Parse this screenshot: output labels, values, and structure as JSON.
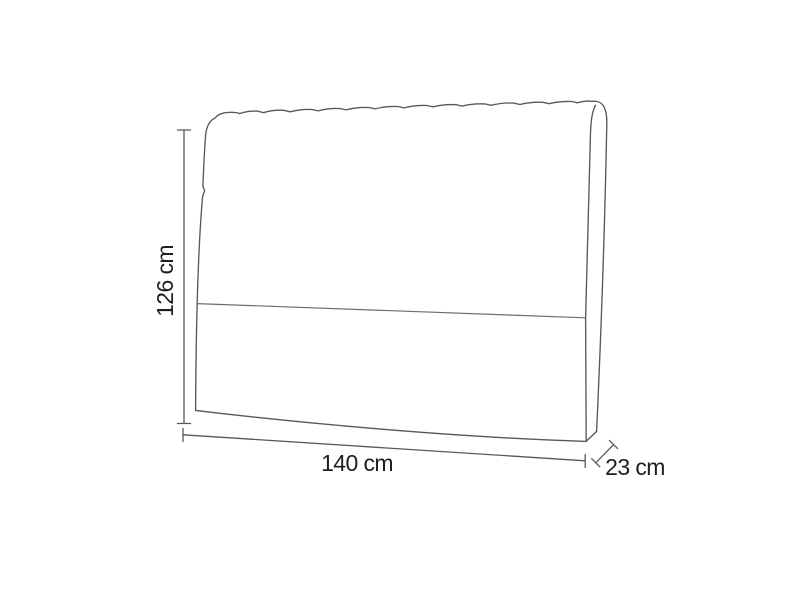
{
  "diagram": {
    "height_label": "126 cm",
    "width_label": "140 cm",
    "depth_label": "23 cm"
  },
  "colors": {
    "background": "#ffffff",
    "line": "#58585a",
    "seam_line": "#6e6e70",
    "label_text": "#1e1e1e"
  }
}
